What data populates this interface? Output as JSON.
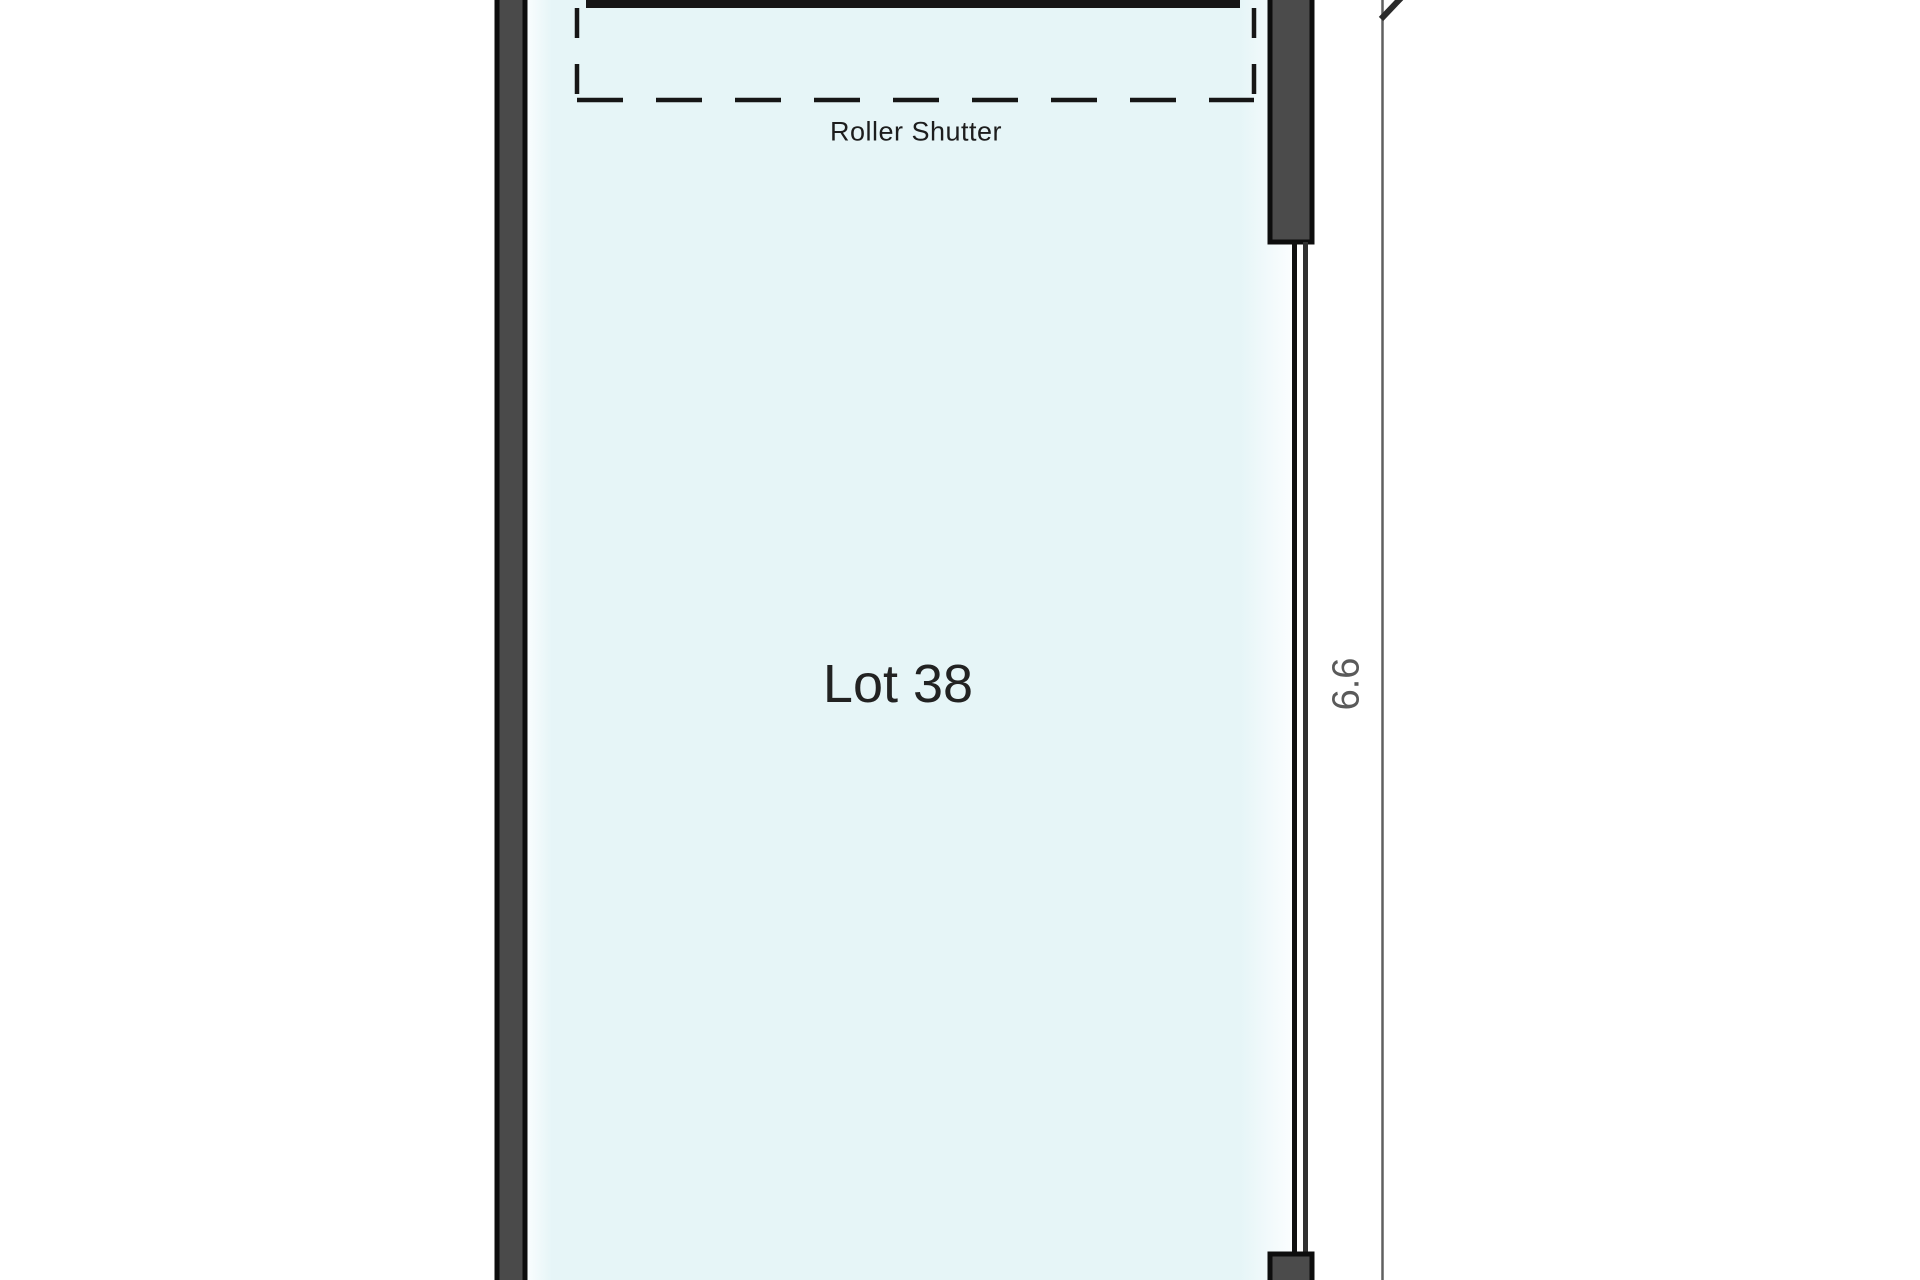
{
  "floor_plan": {
    "unit_label": "Lot 38",
    "shutter_label": "Roller Shutter",
    "right_dimension_label": "6.6",
    "colors": {
      "room_fill": "#e6f5f7",
      "wall_fill": "#4a4a4a",
      "wall_outline": "#0d0d0d",
      "dashed_outline": "#161616",
      "dimension_line": "#606060",
      "dimension_text": "#5a5a5a",
      "label_text": "#1d1d1d",
      "background": "#ffffff"
    }
  }
}
